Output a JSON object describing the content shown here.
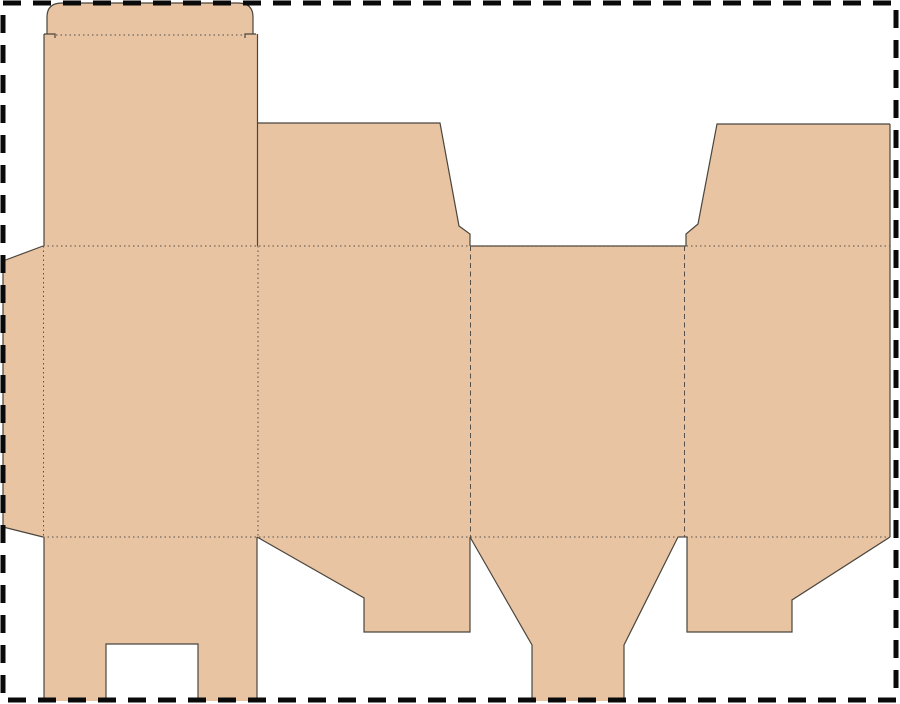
{
  "canvas": {
    "width": 900,
    "height": 704,
    "viewBox": "0 0 900 704",
    "background": "#ffffff"
  },
  "page_border": {
    "color": "#0a0a0a",
    "stroke_width": 5,
    "dash_pattern": "18 12",
    "x": 3,
    "y": 3,
    "width": 893,
    "height": 697
  },
  "dieline": {
    "name": "folding-carton-box-dieline",
    "colors": {
      "board": "#e8c4a2",
      "cut": "#4a453d",
      "fold": "#55504a"
    },
    "stroke": {
      "cut_width": 1.2,
      "fold_width": 1,
      "dot_pattern": "1.5 3",
      "dash_pattern": "5 3.5"
    },
    "panels": [
      {
        "name": "tuck-flap",
        "d": "M47,34 L47,17 Q47,3 62,3 L238,3 Q253,3 253,17 L253,34 Z"
      },
      {
        "name": "top-back-panel",
        "d": "M44,34 L258,34 L258,246 L44,246 Z"
      },
      {
        "name": "top-flap-left",
        "d": "M258,123 L440,123 L459,226 L470,234 L470,246 L258,246 Z"
      },
      {
        "name": "top-flap-right",
        "d": "M717,124 L890,124 L890,246 L686,246 L686,234 L698,224 Z"
      },
      {
        "name": "glue-tab",
        "d": "M43,246 L3,261 L3,527 L43,537 Z"
      },
      {
        "name": "body-band",
        "d": "M43,246 L890,246 L890,537 L43,537 Z"
      },
      {
        "name": "bottom-flap-1",
        "d": "M44,537 L257,537 L257,701 L198,701 L198,644 L106,644 L106,701 L44,701 Z"
      },
      {
        "name": "bottom-flap-2",
        "d": "M257,537 L470,537 L470,632 L364,632 L364,598 Z"
      },
      {
        "name": "bottom-flap-3",
        "d": "M470,537 L678,537 L624,645 L624,701 L532,701 L532,645 Z"
      },
      {
        "name": "bottom-flap-4",
        "d": "M687,537 L890,537 L792,600 L792,632 L687,632 Z"
      }
    ],
    "cut_lines": [
      {
        "name": "tuck-flap-outline",
        "d": "M47,34 L47,17 Q47,3 62,3 L238,3 Q253,3 253,17 L253,34"
      },
      {
        "name": "tuck-notch-left",
        "d": "M44,34 L55,34 L55,38"
      },
      {
        "name": "tuck-notch-right",
        "d": "M256,34 L245,34 L245,38"
      },
      {
        "name": "back-panel-left-edge",
        "d": "M44,34 L44,246"
      },
      {
        "name": "back-panel-right-edge",
        "d": "M257.5,34 L257.5,246"
      },
      {
        "name": "top-flap-left-outline",
        "d": "M258,123 L440,123 L459,226 L470,234 L470,246"
      },
      {
        "name": "band-top-gap-edge",
        "d": "M470,246 L686,246"
      },
      {
        "name": "top-flap-right-outline",
        "d": "M686,246 L686,234 L698,224 L717,124 L890,124"
      },
      {
        "name": "band-right-edge",
        "d": "M890,124 L890,537"
      },
      {
        "name": "glue-tab-outline",
        "d": "M43,246 L3,261 L3,527 L43,537"
      },
      {
        "name": "bottom-flap-1-outline",
        "d": "M44,537 L44,701 M106,701 L106,644 L198,644 L198,701 M257,537 L257,701"
      },
      {
        "name": "bottom-flap-2-outline",
        "d": "M257,537 L364,598 L364,632 L470,632 L470,537"
      },
      {
        "name": "bottom-flap-3-outline",
        "d": "M470,537 L532,645 L532,701 M624,701 L624,645 L678,537"
      },
      {
        "name": "bottom-gap-edge",
        "d": "M678,537 L687,537"
      },
      {
        "name": "bottom-flap-4-outline",
        "d": "M687,537 L687,632 L792,632 L792,600 L890,537"
      }
    ],
    "fold_lines": [
      {
        "name": "tuck-fold",
        "x1": 56,
        "y1": 35,
        "x2": 244,
        "y2": 35,
        "style": "dotted"
      },
      {
        "name": "top-horizontal-fold",
        "x1": 43,
        "y1": 246,
        "x2": 890,
        "y2": 246,
        "style": "dotted"
      },
      {
        "name": "bottom-horizontal-fold",
        "x1": 43,
        "y1": 537,
        "x2": 890,
        "y2": 537,
        "style": "dotted"
      },
      {
        "name": "glue-tab-fold",
        "x1": 43.5,
        "y1": 246,
        "x2": 43.5,
        "y2": 537,
        "style": "dotted"
      },
      {
        "name": "panel-fold-1",
        "x1": 258,
        "y1": 246,
        "x2": 258,
        "y2": 537,
        "style": "dotted"
      },
      {
        "name": "panel-fold-2",
        "x1": 470.5,
        "y1": 246,
        "x2": 470.5,
        "y2": 537,
        "style": "dashed"
      },
      {
        "name": "panel-fold-3",
        "x1": 684.5,
        "y1": 246,
        "x2": 684.5,
        "y2": 537,
        "style": "dashed"
      }
    ]
  }
}
